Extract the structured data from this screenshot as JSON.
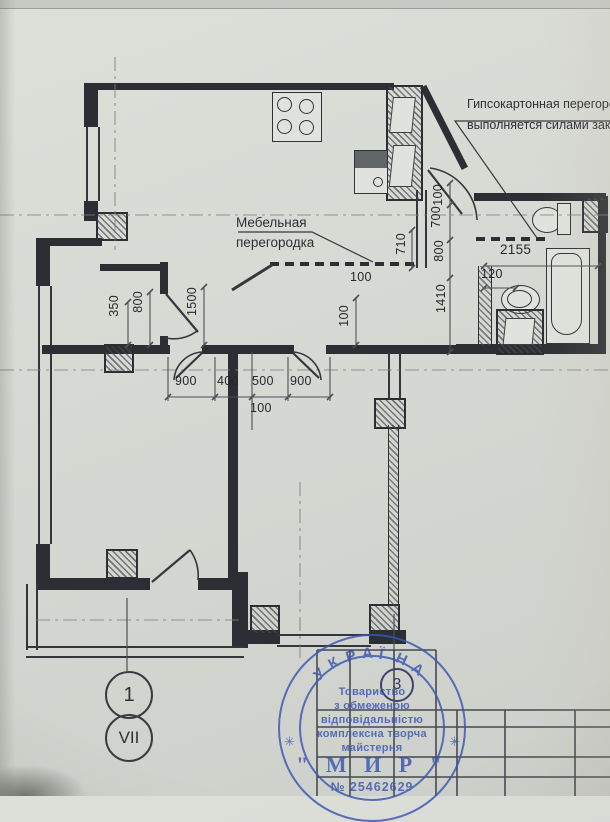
{
  "notes": {
    "furniture_partition": {
      "line1": "Мебельная",
      "line2": "перегородка"
    },
    "gypsum_partition": {
      "line1": "Гипсокартонная перегородка",
      "line2": "выполняется силами заказчика"
    }
  },
  "dimensions": {
    "labels": [
      {
        "t": "350",
        "x": 107,
        "y": 295,
        "v": 1
      },
      {
        "t": "800",
        "x": 131,
        "y": 291,
        "v": 1
      },
      {
        "t": "1500",
        "x": 185,
        "y": 287,
        "v": 1
      },
      {
        "t": "900",
        "x": 175,
        "y": 374
      },
      {
        "t": "400",
        "x": 217,
        "y": 374
      },
      {
        "t": "500",
        "x": 252,
        "y": 374
      },
      {
        "t": "900",
        "x": 290,
        "y": 374
      },
      {
        "t": "100",
        "x": 250,
        "y": 401
      },
      {
        "t": "100",
        "x": 337,
        "y": 305,
        "v": 1
      },
      {
        "t": "100",
        "x": 350,
        "y": 270
      },
      {
        "t": "710",
        "x": 394,
        "y": 233,
        "v": 1
      },
      {
        "t": "100",
        "x": 431,
        "y": 184,
        "v": 1
      },
      {
        "t": "700",
        "x": 429,
        "y": 206,
        "v": 1
      },
      {
        "t": "800",
        "x": 432,
        "y": 240,
        "v": 1
      },
      {
        "t": "1410",
        "x": 434,
        "y": 284,
        "v": 1
      },
      {
        "t": "2155",
        "x": 500,
        "y": 242,
        "big": 1
      },
      {
        "t": "120",
        "x": 481,
        "y": 267
      }
    ]
  },
  "axis_markers": {
    "left_top": "1",
    "left_bottom": "VII",
    "right": "3"
  },
  "stamp": {
    "arc_text": "УКРАЇНА",
    "lines": [
      "Товариство",
      "з обмеженою",
      "відповідальністю",
      "комплексна творча",
      "майстерня"
    ],
    "name": "\" М И Р \"",
    "number": "№ 25462629",
    "star": "✳",
    "color": "#3b55b2"
  },
  "colors": {
    "paper": "#d6d9d3",
    "line": "#2b2f33",
    "stamp_blue": "#3b55b2"
  }
}
